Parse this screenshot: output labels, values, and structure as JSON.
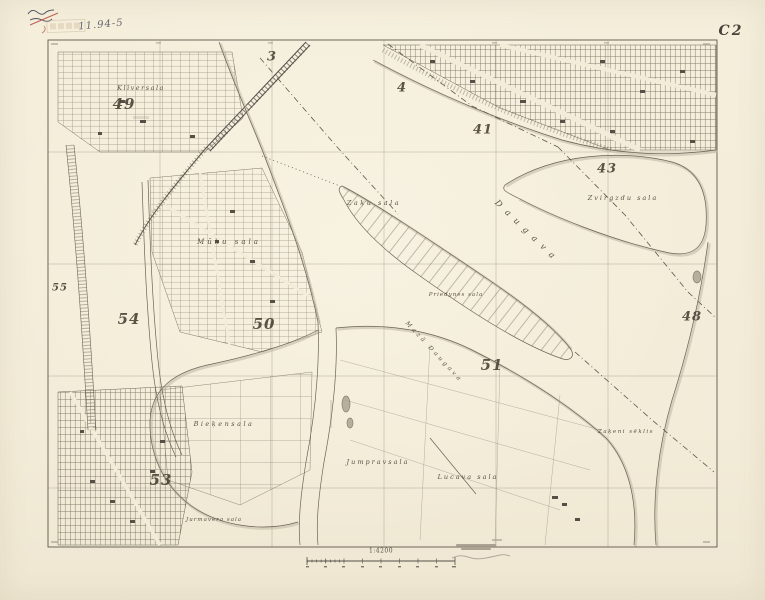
{
  "sheet": {
    "code": "C2",
    "scale": "1:4200",
    "handwritten_note": "11.94-5"
  },
  "colors": {
    "paper": "#f3ecd9",
    "ink": "#6b6456",
    "ink_dark": "#55504a",
    "shade": "#c4bbaa",
    "red_mark": "#b5483a"
  },
  "grid_numbers": [
    {
      "n": "3",
      "x": 272,
      "y": 57,
      "s": 13
    },
    {
      "n": "4",
      "x": 402,
      "y": 88,
      "s": 13
    },
    {
      "n": "41",
      "x": 483,
      "y": 130,
      "s": 13
    },
    {
      "n": "43",
      "x": 607,
      "y": 169,
      "s": 13
    },
    {
      "n": "48",
      "x": 692,
      "y": 317,
      "s": 13
    },
    {
      "n": "49",
      "x": 124,
      "y": 104,
      "s": 15
    },
    {
      "n": "50",
      "x": 264,
      "y": 324,
      "s": 15
    },
    {
      "n": "51",
      "x": 492,
      "y": 365,
      "s": 15
    },
    {
      "n": "53",
      "x": 161,
      "y": 480,
      "s": 15
    },
    {
      "n": "54",
      "x": 129,
      "y": 319,
      "s": 15
    },
    {
      "n": "55",
      "x": 60,
      "y": 288,
      "s": 10
    }
  ],
  "map_labels": [
    {
      "text": "Klīversala",
      "x": 141,
      "y": 88,
      "size": 6.5,
      "sp": 1.5,
      "rot": 0
    },
    {
      "text": "Mūku sala",
      "x": 229,
      "y": 242,
      "size": 7,
      "sp": 3,
      "rot": 0
    },
    {
      "text": "Zaķu sala",
      "x": 374,
      "y": 203,
      "size": 6.5,
      "sp": 2.5,
      "rot": 0
    },
    {
      "text": "Daugava",
      "x": 527,
      "y": 232,
      "size": 8.5,
      "sp": 7,
      "rot": 44
    },
    {
      "text": "Zvirgzdu sala",
      "x": 623,
      "y": 198,
      "size": 6.5,
      "sp": 2,
      "rot": 0
    },
    {
      "text": "Priedynes sala",
      "x": 456,
      "y": 295,
      "size": 5.5,
      "sp": 1,
      "rot": 0
    },
    {
      "text": "Mazā Daugava",
      "x": 434,
      "y": 352,
      "size": 6,
      "sp": 3,
      "rot": 47
    },
    {
      "text": "Bieķensala",
      "x": 224,
      "y": 424,
      "size": 6.5,
      "sp": 2.5,
      "rot": 0
    },
    {
      "text": "Jumpravsala",
      "x": 378,
      "y": 462,
      "size": 6.5,
      "sp": 2,
      "rot": 0
    },
    {
      "text": "Lucava sala",
      "x": 468,
      "y": 477,
      "size": 6.5,
      "sp": 2,
      "rot": 0
    },
    {
      "text": "Zaķeni sēklis",
      "x": 626,
      "y": 432,
      "size": 5.5,
      "sp": 1.5,
      "rot": 0
    },
    {
      "text": "Jurmavera sala",
      "x": 214,
      "y": 520,
      "size": 5.5,
      "sp": 1,
      "rot": 0
    }
  ]
}
